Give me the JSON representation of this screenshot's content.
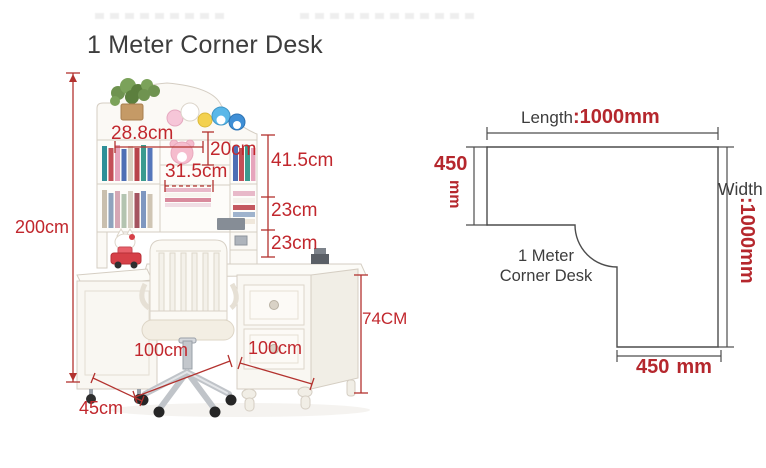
{
  "title": "1 Meter Corner Desk",
  "colors": {
    "photo_dimension_red": "#c1272d",
    "plan_red": "#b5272d",
    "text_dark": "#3d3d3d",
    "plan_line_gray": "#4d4d4d",
    "furniture_white": "#f9f7f2"
  },
  "desk_figure": {
    "labels": {
      "total_height": "200cm",
      "hutch_width": "28.8cm",
      "shelf_height": "20cm",
      "shelf_width": "31.5cm",
      "top_section": "41.5cm",
      "mid_section": "23cm",
      "low_section": "23cm",
      "desk_height": "74CM",
      "left_length": "100cm",
      "right_length": "100cm",
      "depth": "45cm"
    }
  },
  "floor_plan": {
    "length_label": "Length",
    "length_value": ":1000mm",
    "side_value": "450",
    "side_unit": "mm",
    "width_label": "Width",
    "width_value": ":1000mm",
    "name_line1": "1 Meter",
    "name_line2": "Corner Desk",
    "bottom_value": "450",
    "bottom_unit": "mm"
  }
}
